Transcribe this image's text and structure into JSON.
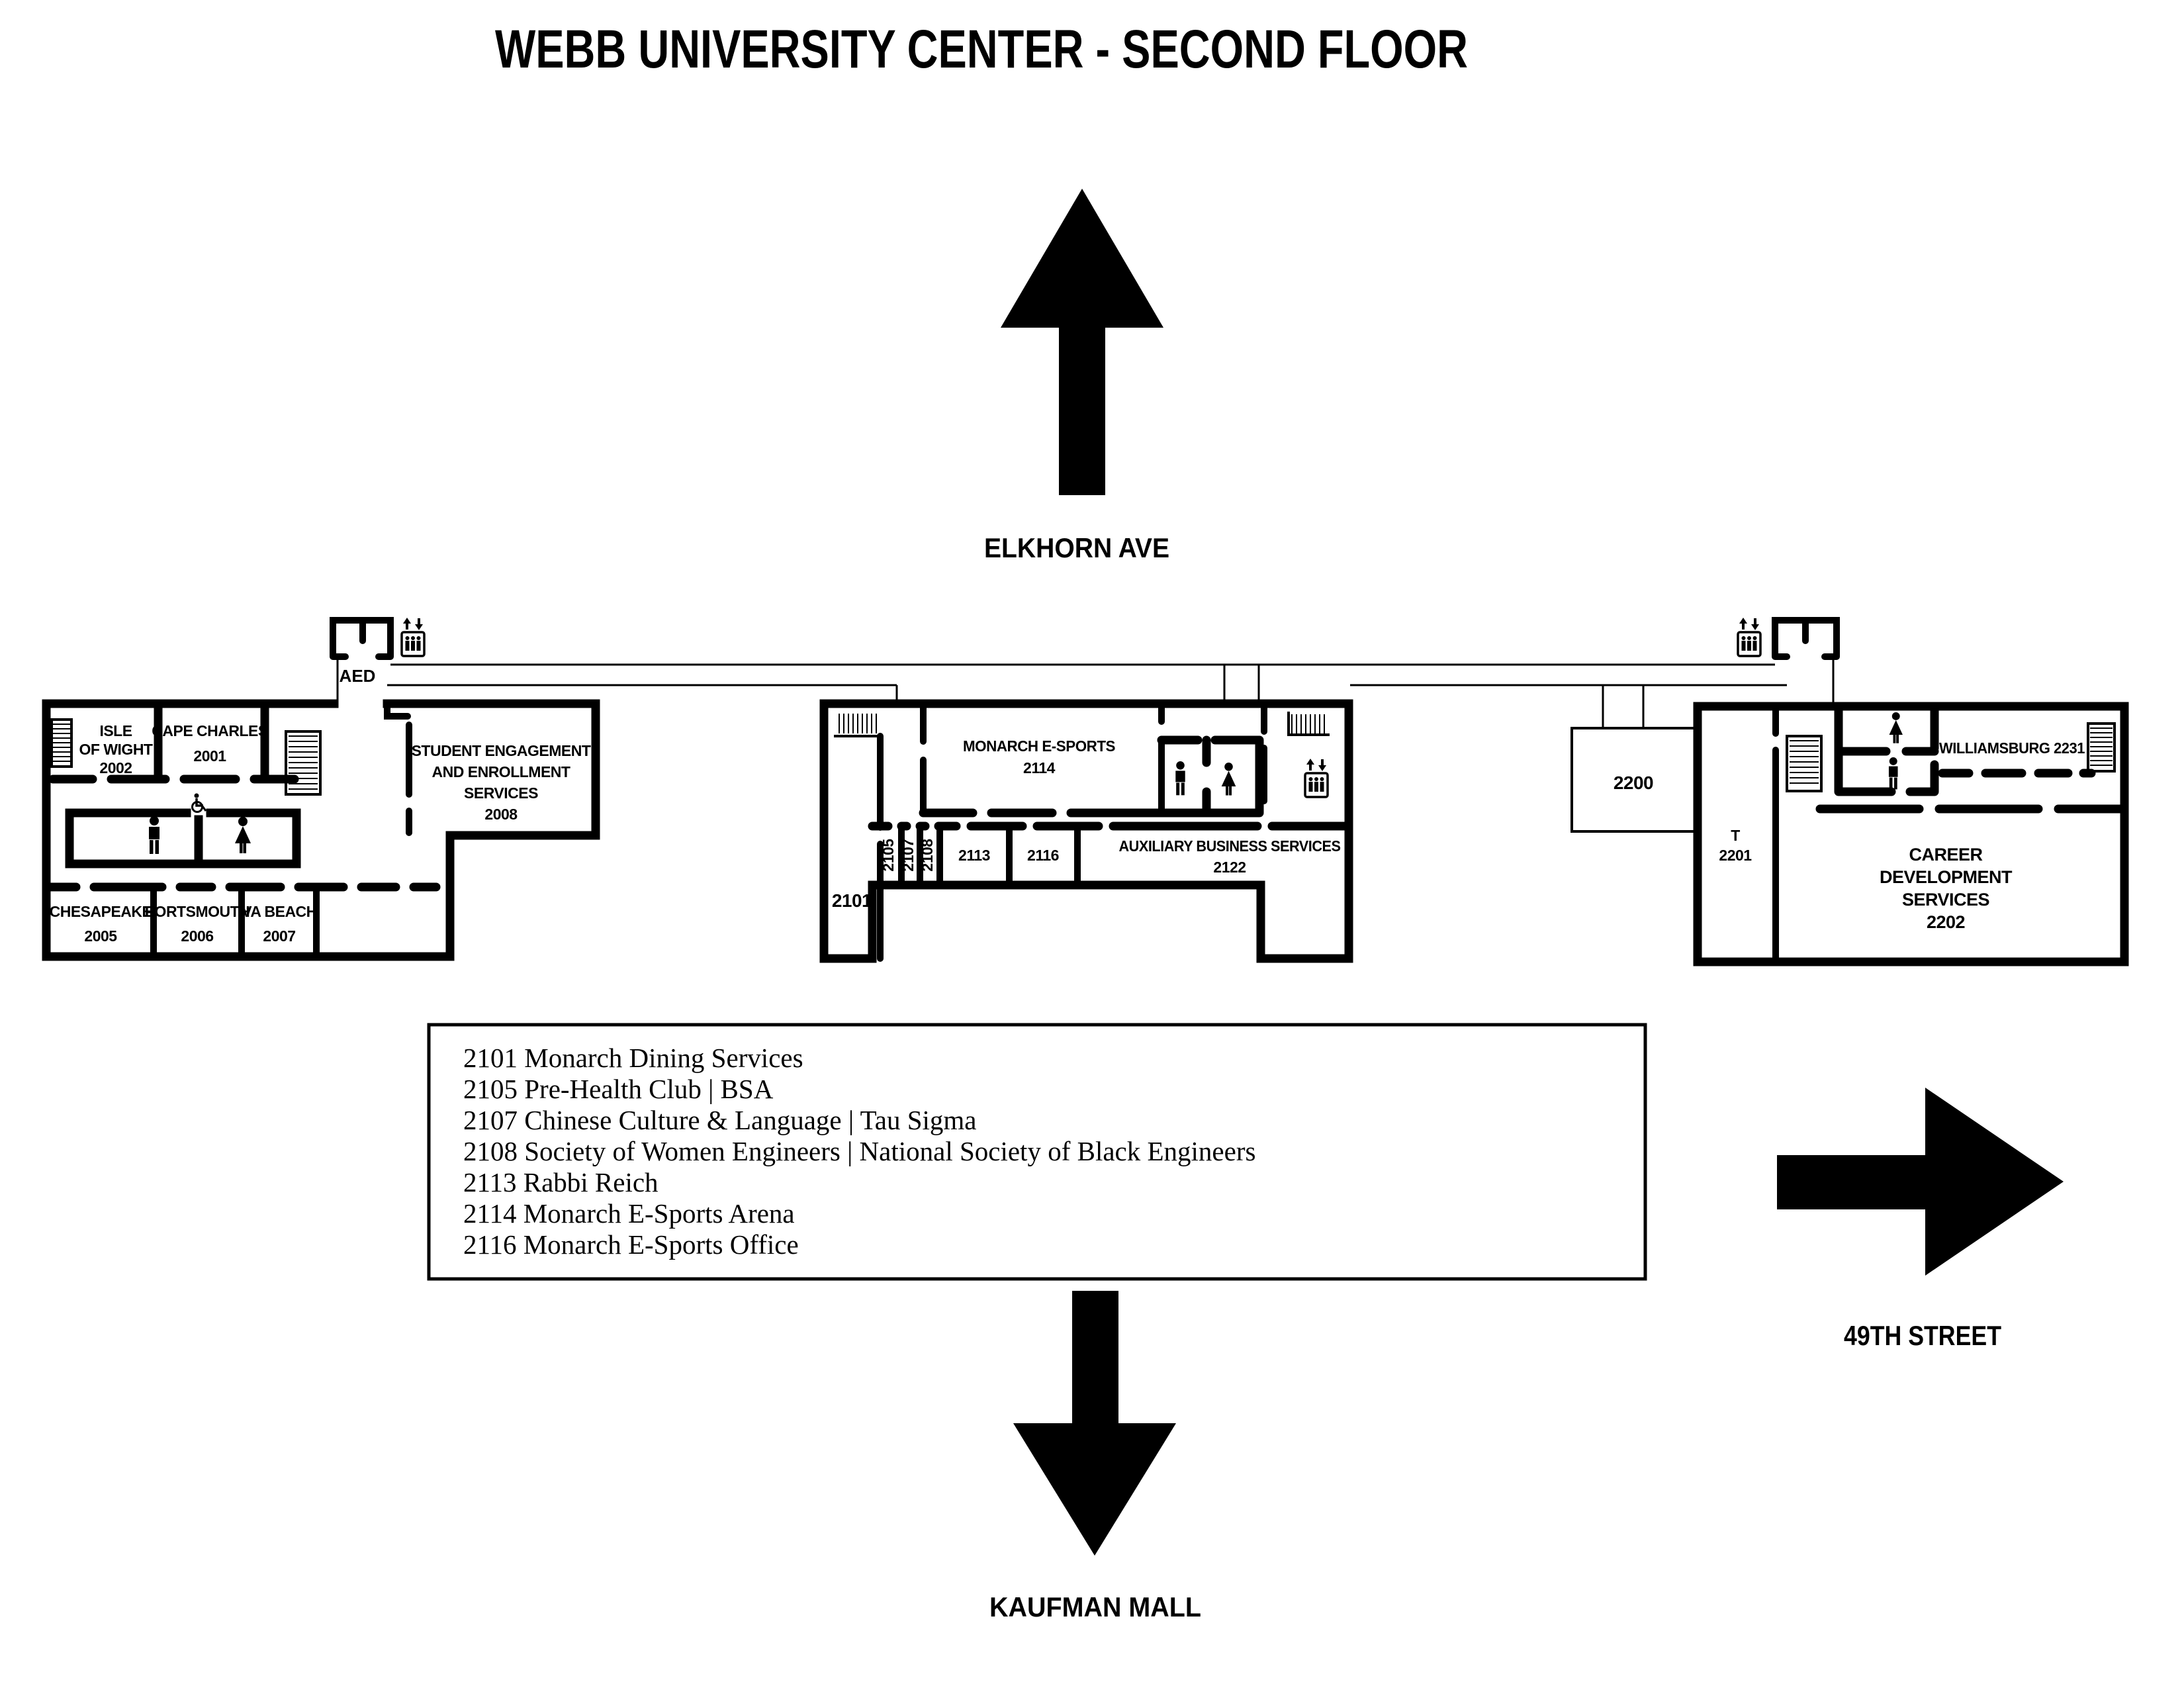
{
  "title": "WEBB UNIVERSITY CENTER - SECOND FLOOR",
  "streets": {
    "north": "ELKHORN AVE",
    "south": "KAUFMAN MALL",
    "east": "49TH STREET"
  },
  "west_wing": {
    "aed": "AED",
    "rooms": {
      "isle_of_wight": {
        "lines": [
          "ISLE",
          "OF WIGHT"
        ],
        "number": "2002"
      },
      "cape_charles": {
        "lines": [
          "CAPE CHARLES"
        ],
        "number": "2001"
      },
      "chesapeake": {
        "lines": [
          "CHESAPEAKE"
        ],
        "number": "2005"
      },
      "portsmouth": {
        "lines": [
          "PORTSMOUTH"
        ],
        "number": "2006"
      },
      "va_beach": {
        "lines": [
          "VA BEACH"
        ],
        "number": "2007"
      },
      "student_engagement": {
        "lines": [
          "STUDENT ENGAGEMENT",
          "AND ENROLLMENT",
          "SERVICES"
        ],
        "number": "2008"
      }
    }
  },
  "central_wing": {
    "rooms": {
      "dining": {
        "number": "2101"
      },
      "esports_arena": {
        "lines": [
          "MONARCH E-SPORTS"
        ],
        "number": "2114"
      },
      "r2105": {
        "number": "2105"
      },
      "r2107": {
        "number": "2107"
      },
      "r2108": {
        "number": "2108"
      },
      "r2113": {
        "number": "2113"
      },
      "r2116": {
        "number": "2116"
      },
      "auxiliary": {
        "lines": [
          "AUXILIARY  BUSINESS SERVICES"
        ],
        "number": "2122"
      }
    }
  },
  "east_wing": {
    "rooms": {
      "r2200": {
        "number": "2200"
      },
      "t2201": {
        "lines": [
          "T"
        ],
        "number": "2201"
      },
      "williamsburg": {
        "label": "WILLIAMSBURG 2231"
      },
      "career": {
        "lines": [
          "CAREER",
          "DEVELOPMENT",
          "SERVICES"
        ],
        "number": "2202"
      }
    }
  },
  "legend": {
    "entries": [
      "2101 Monarch Dining Services",
      "2105 Pre-Health Club | BSA",
      "2107 Chinese Culture & Language | Tau Sigma",
      "2108 Society of Women Engineers | National Society of Black Engineers",
      "2113 Rabbi Reich",
      "2114 Monarch E-Sports Arena",
      "2116 Monarch E-Sports Office"
    ]
  }
}
